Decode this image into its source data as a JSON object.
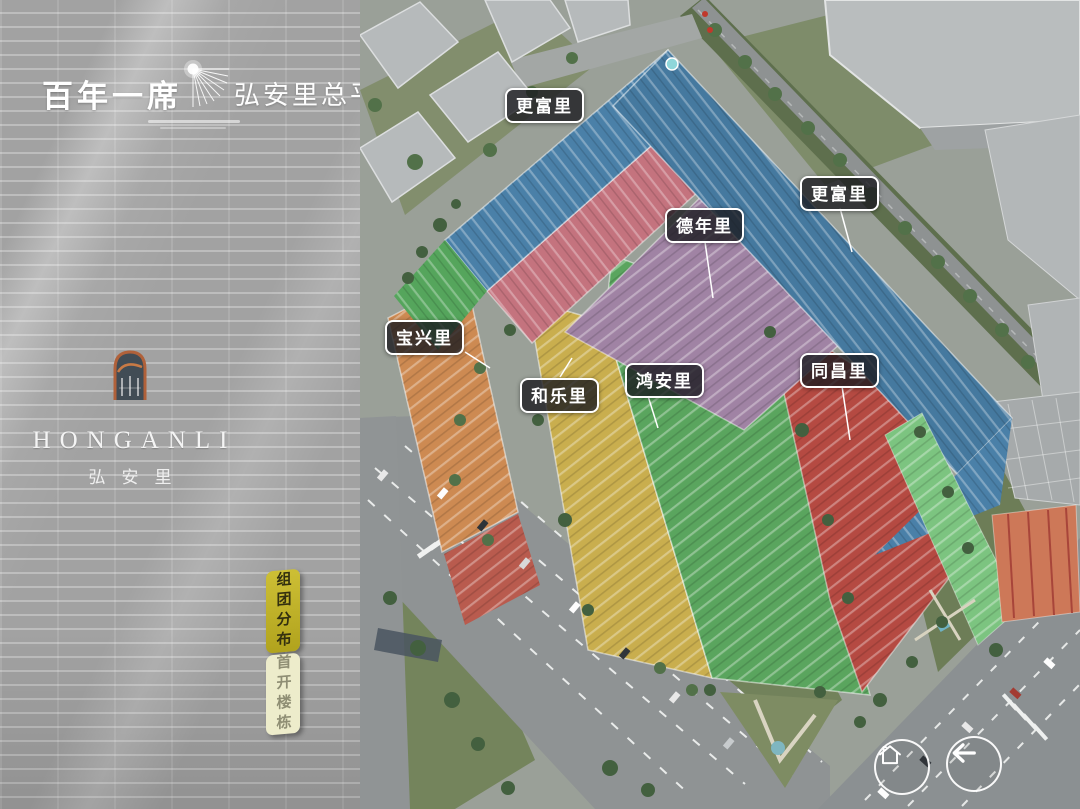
{
  "sidebar": {
    "tagline": "百年一席",
    "title": "弘安里总平图",
    "logo": {
      "en": "HONGANLI",
      "cn": "弘安里"
    },
    "tabs": [
      {
        "label": "组团分布",
        "active": true
      },
      {
        "label": "首开楼栋",
        "active": false
      }
    ]
  },
  "map": {
    "zone_labels": [
      {
        "name": "更富里"
      },
      {
        "name": "更富里"
      },
      {
        "name": "德年里"
      },
      {
        "name": "宝兴里"
      },
      {
        "name": "和乐里"
      },
      {
        "name": "鸿安里"
      },
      {
        "name": "同昌里"
      }
    ],
    "zones": [
      {
        "name": "更富里",
        "color": "#4a80a8"
      },
      {
        "name": "德年里",
        "color": "#a083a4"
      },
      {
        "name": "宝兴里",
        "color": "#cd8a52"
      },
      {
        "name": "和乐里",
        "color": "#c9ae4e"
      },
      {
        "name": "鸿安里",
        "color": "#5aa55e"
      },
      {
        "name": "同昌里",
        "color": "#b54a42"
      }
    ],
    "controls": [
      {
        "icon": "home"
      },
      {
        "icon": "back"
      }
    ]
  },
  "colors": {
    "accent_gold": "#c6b832",
    "label_bg": "rgba(28,28,33,0.8)",
    "zone_pink_row": "#c4737e",
    "brick_gray": "#a8a8a8"
  }
}
